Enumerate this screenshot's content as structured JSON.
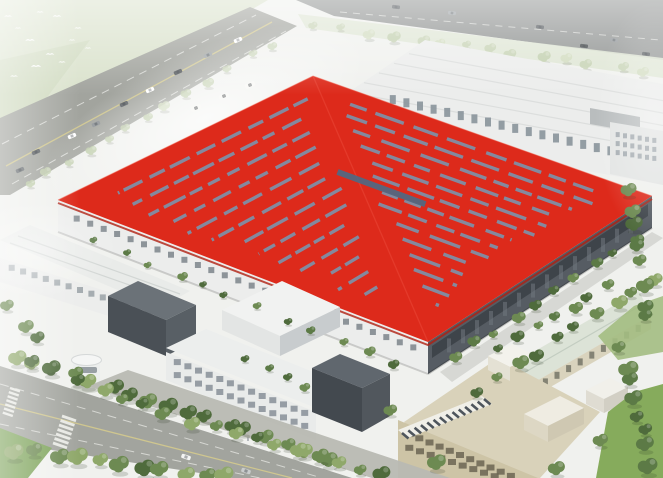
{
  "meta": {
    "description": "Aerial bird's-eye architectural rendering of an industrial campus: one large factory hall with a vivid red roof crossed by herringbone rows of blue-grey skylight strips, a long white rear plant, a bottom-left warehouse, a central office block, a beige annex with rooftop solar panels, a pale-green-roofed utility hall, tree-lined boulevards with crosswalks and cars, and white birds over fields in the top-left corner.",
    "image_type": "architectural-rendering",
    "visible_text": []
  },
  "palette": {
    "red": "#DD2A1B",
    "red_shadow": "#B01F12",
    "stripe": "#7E91A8",
    "stripe_dark": "#546881",
    "wall_white": "#ECEDEC",
    "wall_light": "#E3E5E4",
    "wall_mid": "#C8CCCE",
    "wall_dark": "#4A5056",
    "wall_darker": "#3E444A",
    "glass": "#7C848B",
    "road": "#A2A49E",
    "road_dark": "#8E9190",
    "line_yellow": "#CFC68F",
    "line_white": "#E3E4E0",
    "tree_dark": "#4F6B3C",
    "tree_mid": "#6D8A52",
    "tree_light": "#8FA86A",
    "tree_pale": "#C2CFAE",
    "lawn": "#7EA45B",
    "lawn_bright": "#86AB5C",
    "field": "#D6DFC6",
    "beige_wall": "#CDC4A6",
    "beige_roof": "#D9D2BA",
    "green_roof": "#DCE3D7",
    "cream_wall": "#D9D3BD",
    "bg": "#F0F1EE",
    "solar": "#4E555C"
  },
  "roof": {
    "corners": {
      "top": [
        313,
        76
      ],
      "left": [
        58,
        200
      ],
      "right": [
        652,
        196
      ],
      "bottom": [
        428,
        342
      ]
    },
    "stripe_rows": 15,
    "row_start": 0.07,
    "row_step": 0.058,
    "dash_len": 0.062,
    "dash_gap": 0.02,
    "margin": 0.045,
    "edge_clamp": 0.93,
    "stripe_width": 3.4,
    "center_strip": {
      "a": 0.4,
      "b1": 0.36,
      "b2": 0.61,
      "width": 6
    }
  },
  "scene": {
    "elements": [
      "top-left-field-with-birds",
      "top-left-highway",
      "top-right-road",
      "rear-white-plant",
      "main-factory-red-roof",
      "main-factory-walls",
      "left-warehouse",
      "gatehouse",
      "front-office-block",
      "entrance-canopy",
      "beige-annex-with-solar-panels",
      "green-roof-utility-hall",
      "small-white-hut",
      "boulevard-with-crosswalks",
      "inner-campus-road",
      "tree-rows",
      "lawns",
      "haze"
    ],
    "counts": {
      "birds": 12,
      "highway_cars": 9,
      "top_road_cars": 6,
      "boulevard_cars": 2,
      "white_vans": 3
    }
  }
}
